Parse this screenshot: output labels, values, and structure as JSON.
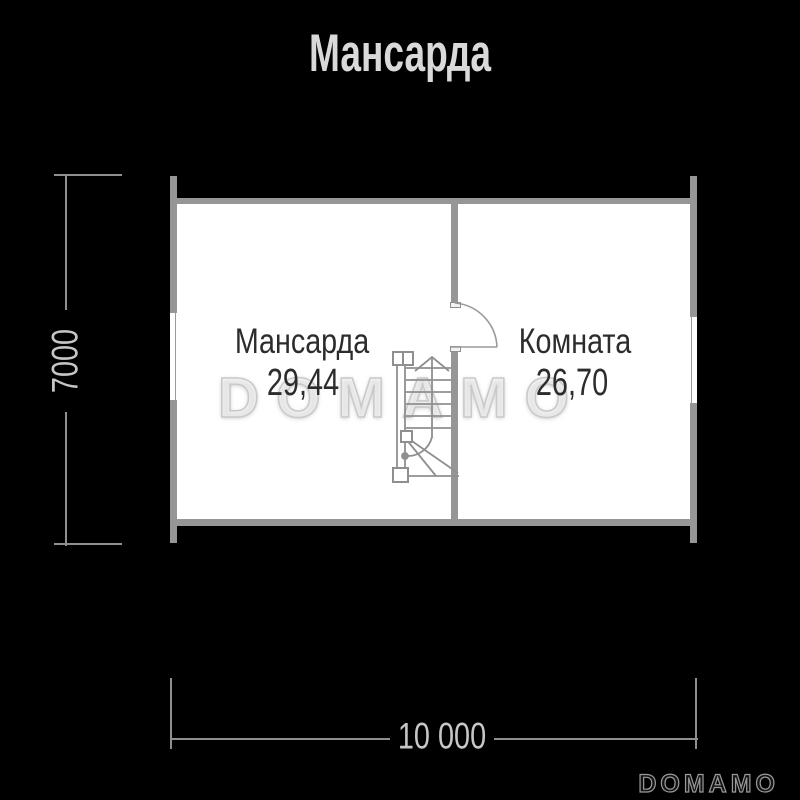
{
  "title": "Мансарда",
  "plan": {
    "rooms": [
      {
        "name": "Мансарда",
        "area": "29,44"
      },
      {
        "name": "Комната",
        "area": "26,70"
      }
    ]
  },
  "dimensions": {
    "vertical": "7000",
    "horizontal": "10 000"
  },
  "watermark": "DOMAMO",
  "footer_logo": "DOMAMO",
  "colors": {
    "background": "#000000",
    "wall": "#969696",
    "dimension_line": "#8f8f8f",
    "dimension_text": "#c6c6c6",
    "title_text": "#d9d9d9",
    "room_text": "#2c2c2c",
    "room_fill": "#ffffff",
    "watermark_stroke": "#c9c9c9"
  }
}
